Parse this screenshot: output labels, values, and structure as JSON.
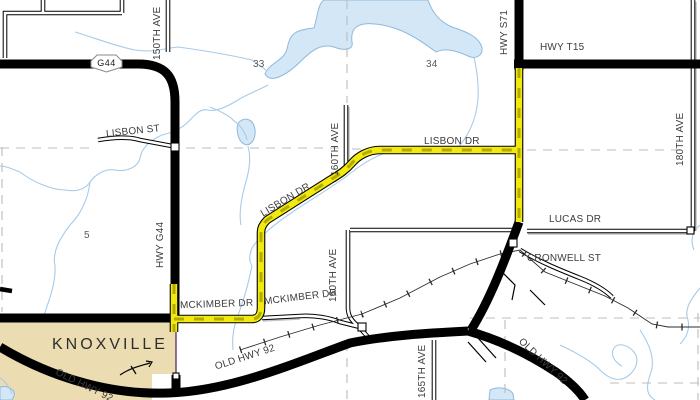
{
  "map_title": "Knoxville area road map with highlighted route",
  "town": {
    "name": "KNOXVILLE"
  },
  "shield": {
    "g44": "G44"
  },
  "sections": {
    "nw": "33",
    "ne": "34",
    "w": "5"
  },
  "labels": {
    "ave_150": "150TH AVE",
    "lisbon_st": "LISBON ST",
    "hwy_g44": "HWY G44",
    "ave_160_n": "160TH AVE",
    "ave_160_s": "160TH AVE",
    "lisbon_dr_diag": "LISBON DR",
    "lisbon_dr_east": "LISBON DR",
    "hwy_s71": "HWY S71",
    "hwy_t15": "HWY T15",
    "ave_180": "180TH AVE",
    "lucas_dr": "LUCAS DR",
    "cronwell_st": "CRONWELL ST",
    "mckimber_dr_w": "MCKIMBER DR",
    "mckimber_dr_e": "MCKIMBER DR",
    "ave_165": "165TH AVE",
    "old_hwy_92_w": "OLD HWY 92",
    "old_hwy_92_c": "OLD HWY 92",
    "old_hwy_92_e": "OLD HWY 92"
  },
  "colors": {
    "water": "#d3e7f6",
    "water_edge": "#8fb9dd",
    "stream": "#a6cbe9",
    "city_fill": "#ecdcb2",
    "boundary": "#5c2a5e",
    "route_yellow": "#f2e90e",
    "route_dash": "#b3aa00",
    "road_black": "#000000",
    "section_line": "#bcbcbc",
    "label": "#3c3c3c",
    "section_num": "#5a5a5a"
  }
}
